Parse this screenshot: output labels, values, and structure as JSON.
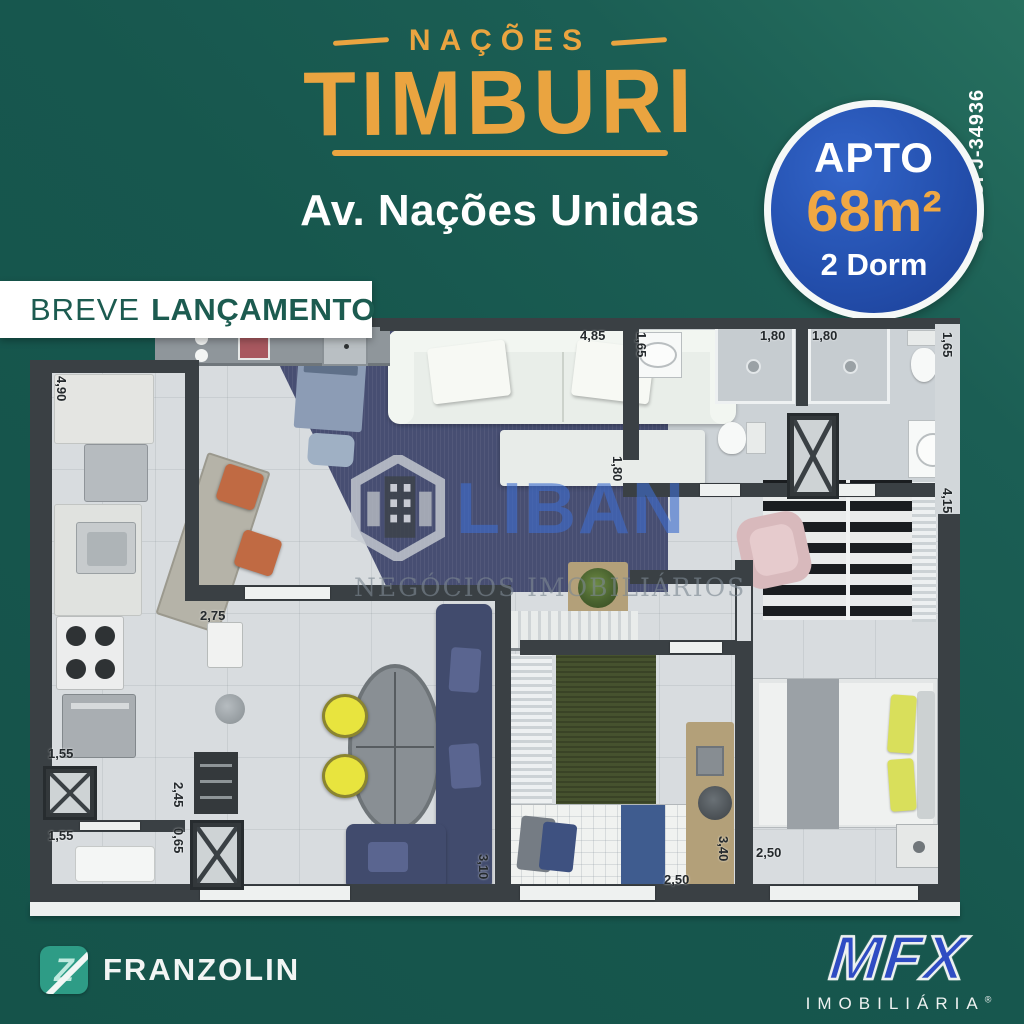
{
  "page": {
    "background": "#17574e",
    "accent_orange": "#eaa440"
  },
  "header": {
    "brand_top": "NAÇÕES",
    "brand_main": "TIMBURI",
    "address": "Av. Nações Unidas",
    "creci": "CRECI J-34936"
  },
  "badge": {
    "line1": "APTO",
    "area": "68m²",
    "line2": "2 Dorm",
    "bg_color": "#2450ae",
    "area_color": "#f0a843"
  },
  "banner": {
    "light": "BREVE",
    "bold": "LANÇAMENTO"
  },
  "watermark": {
    "name": "LIBAN",
    "tagline": "NEGÓCIOS IMOBILIÁRIOS",
    "name_color": "#3e6ccd",
    "building_icon": "liban-building-icon"
  },
  "floorplan": {
    "dims": {
      "kitchen_len": "4,90",
      "living_len": "4,85",
      "bath1_sink": "1,65",
      "bath1_w": "1,80",
      "bath2_w": "1,80",
      "bath2_sink": "1,65",
      "hall": "1,80",
      "master_len": "4,15",
      "kitchen_w": "2,75",
      "sofa_len": "3,10",
      "shaft_w": "1,55",
      "service": "2,45",
      "service2": "0,65",
      "laundry_w": "1,55",
      "bed2_len": "3,40",
      "bed2_w": "2,50",
      "master_w": "2,50"
    }
  },
  "footer": {
    "franzolin": {
      "name": "FRANZOLIN",
      "icon_color": "#2e9c86"
    },
    "mfx": {
      "name": "MFX",
      "sub": "IMOBILIÁRIA",
      "reg": "®",
      "color": "#2f4cc3"
    }
  }
}
